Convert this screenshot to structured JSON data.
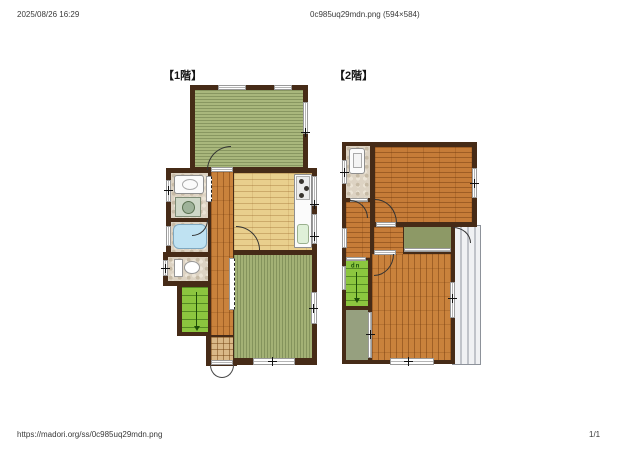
{
  "page": {
    "header": {
      "datetime": "2025/08/26 16:29",
      "title": "0c985uq29mdn.png (594×584)"
    },
    "footer": {
      "url": "https://madori.org/ss/0c985uq29mdn.png",
      "page_number": "1/1"
    }
  },
  "floorplan": {
    "floor1_label": "【1階】",
    "floor2_label": "【2階】",
    "stair_up_label": "up",
    "colors": {
      "wall": "#462b17",
      "tatami": "#a9b77c",
      "wood_corridor": "#c9823c",
      "wood_room": "#c67c38",
      "kitchen_floor": "#e9cf8d",
      "stone_tile": "#ddd3c3",
      "genkan_tile": "#d9b887",
      "stairs_green": "#8cc63f",
      "closet_olive": "#8d9966",
      "bathtub_blue": "#bfe2f2",
      "balcony_gray": "#c0c3c9"
    }
  }
}
